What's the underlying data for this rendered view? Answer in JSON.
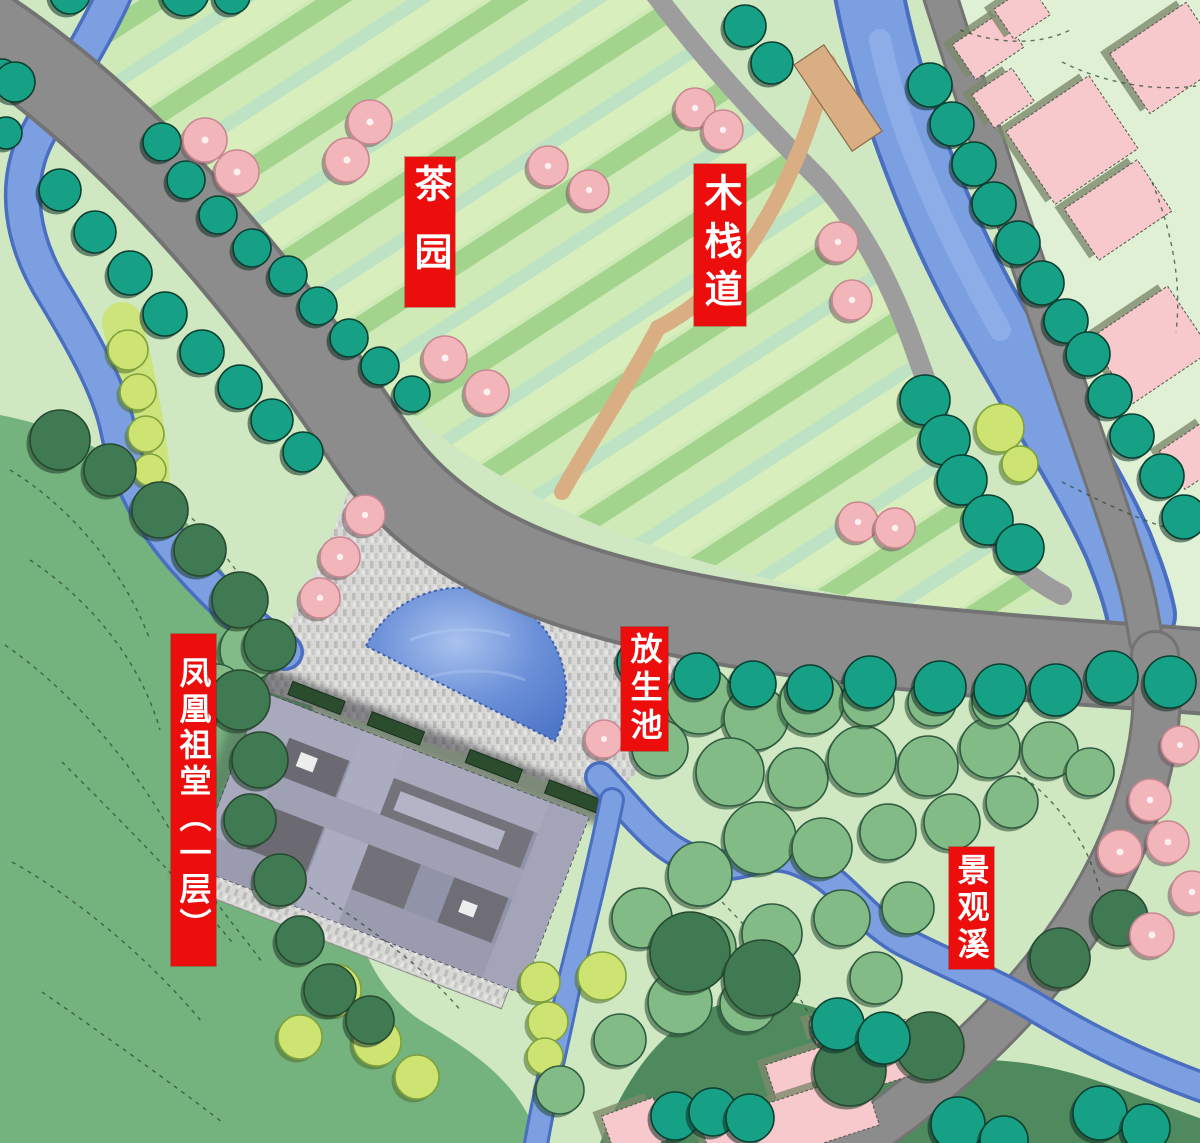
{
  "map": {
    "kind": "landscape-master-plan",
    "labels": [
      {
        "id": "tea-garden",
        "text": "茶园"
      },
      {
        "id": "wooden-boardwalk",
        "text": "木栈道"
      },
      {
        "id": "release-pond",
        "text": "放生池"
      },
      {
        "id": "phoenix-ancestral-hall",
        "text": "凤凰祖堂（一层）"
      },
      {
        "id": "landscape-stream",
        "text": "景观溪"
      }
    ],
    "colors": {
      "label_bg": "#ec0d0d",
      "label_text": "#ffffff",
      "bg_green": "#cfe8c2",
      "pale_green": "#dff0d4",
      "hill_green": "#74b27e",
      "dark_forest": "#4e8a5e",
      "darker_forest": "#3f7a52",
      "road": "#8c8c8c",
      "road_edge": "#737373",
      "path_gray": "#9d9d9d",
      "water": "#7b9fe0",
      "water_edge": "#4a6ec0",
      "water_light": "#9ab7ec",
      "pond": "#6b90d8",
      "plaza": "#d8d8d6",
      "boardwalk": "#d9ae83",
      "tea_bush": "#b7c95f",
      "tea_bush_edge": "#5c6b2f",
      "teal_tree": "#16a085",
      "teal_tree_edge": "#0a3f30",
      "pink_tree": "#f2b6ba",
      "pink_tree_edge": "#c98791",
      "green_tree": "#82bb85",
      "green_tree_edge": "#2f5b41",
      "yellow_tree": "#cde473",
      "building_roof": "#a8a9bc",
      "building_mid": "#9194a8",
      "courtyard": "#6b6a72",
      "hedge": "#2c4c2e",
      "house_pink": "#f7c9cd",
      "house_shadow": "#7d8a6d",
      "contour": "#2c4a33"
    }
  }
}
